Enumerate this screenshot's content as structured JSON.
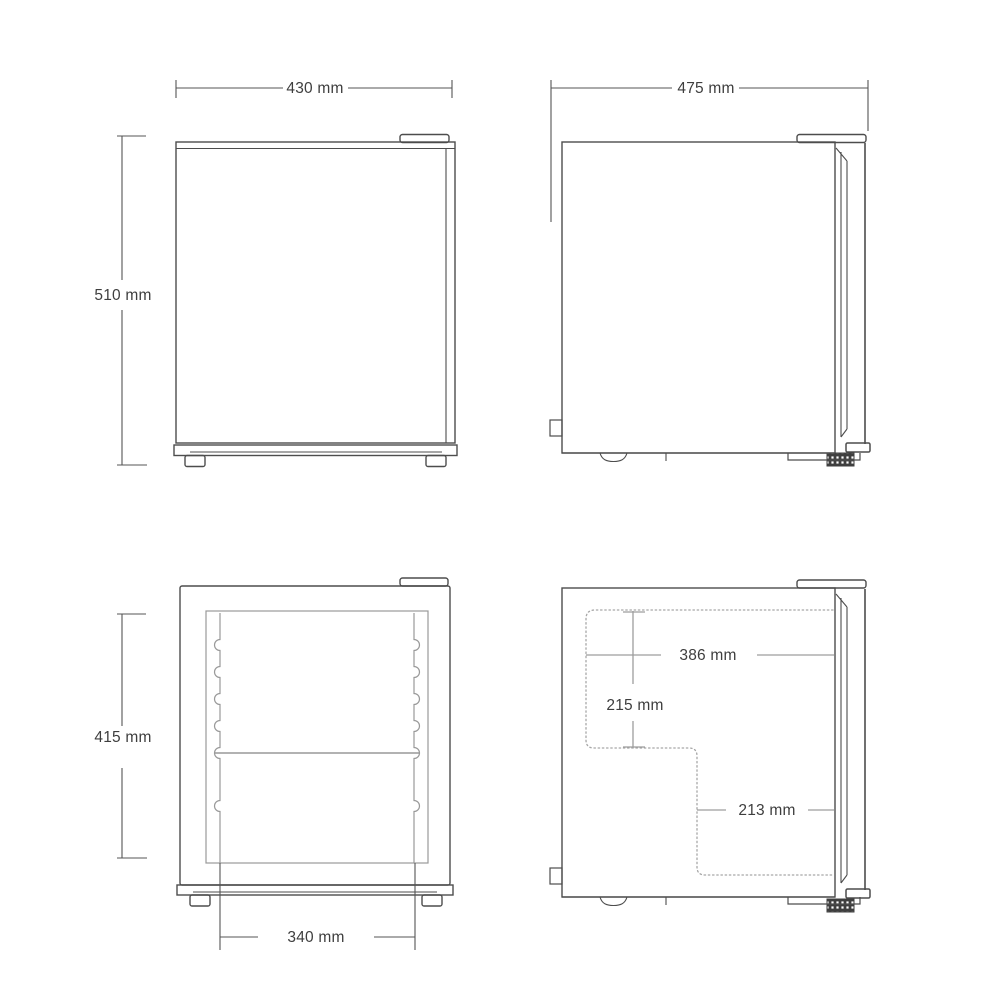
{
  "diagram": {
    "product": "Mini refrigerator dimension drawing",
    "unit": "mm",
    "labels": {
      "exterior_width": "430 mm",
      "exterior_height": "510 mm",
      "exterior_depth": "475 mm",
      "interior_height": "415 mm",
      "interior_width": "340 mm",
      "interior_depth_upper": "386 mm",
      "interior_height_upper": "215 mm",
      "interior_depth_lower": "213 mm"
    },
    "values_mm": {
      "exterior_width": 430,
      "exterior_height": 510,
      "exterior_depth": 475,
      "interior_height": 415,
      "interior_width": 340,
      "interior_depth_upper": 386,
      "interior_height_upper": 215,
      "interior_depth_lower": 213
    },
    "views": [
      {
        "id": "front-exterior",
        "dimensions": [
          "430 mm",
          "510 mm"
        ]
      },
      {
        "id": "side-exterior",
        "dimensions": [
          "475 mm"
        ]
      },
      {
        "id": "front-interior",
        "dimensions": [
          "415 mm",
          "340 mm"
        ]
      },
      {
        "id": "side-interior",
        "dimensions": [
          "386 mm",
          "215 mm",
          "213 mm"
        ]
      }
    ],
    "colors": {
      "background": "#ffffff",
      "outline": "#4d4d4d",
      "dimension_line": "#555555",
      "interior_dimension_line": "#9d9d9d",
      "dotted_line": "#a6a6a6",
      "text": "#3e3e3e"
    }
  }
}
